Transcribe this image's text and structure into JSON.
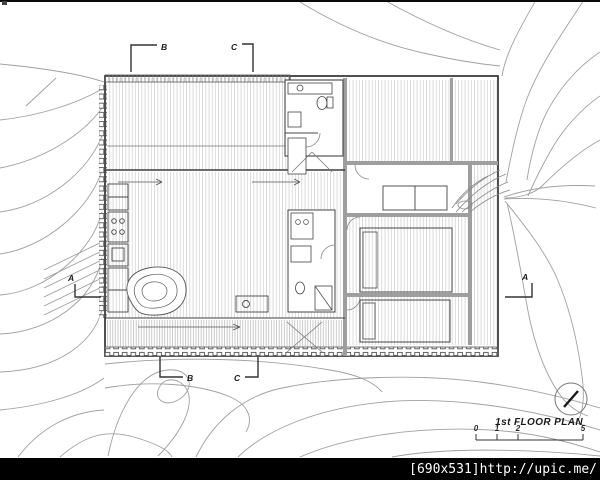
{
  "drawing": {
    "title": "1st FLOOR PLAN",
    "scale": {
      "labels": [
        "0",
        "1",
        "2",
        "5"
      ]
    },
    "markers": {
      "a_left": "A",
      "a_right": "A",
      "b_top": "B",
      "b_bottom": "B",
      "c_top": "C",
      "c_bottom": "C"
    },
    "colors": {
      "paper": "#ffffff",
      "ink": "#3d3d3d",
      "contour": "#a0a0a0",
      "hatch": "#cccccc",
      "wall_fill": "#9e9e9e",
      "watermark_bg": "#000000",
      "watermark_text": "#ffffff"
    }
  },
  "watermark": {
    "text": "[690x531]http://upic.me/"
  }
}
